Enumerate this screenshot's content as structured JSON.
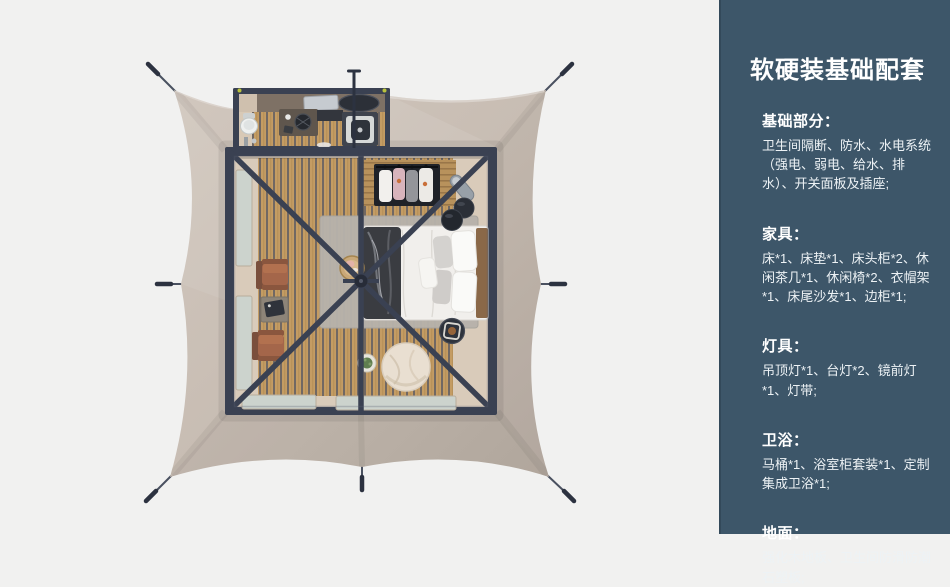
{
  "colors": {
    "bg": "#f1f1f0",
    "canvas-light": "#d1c7be",
    "canvas-mid": "#c7bcb2",
    "canvas-dark": "#b9aea4",
    "frame": "#3a4152",
    "frame-dark": "#2c3240",
    "frame-light": "#59607a",
    "wood": "#c49c63",
    "wood-stripe": "#5d5b63",
    "wood-light": "#b08a52",
    "slat-wood": "#b8925c",
    "slat-stripe": "#8f6c42",
    "beige": "#d9cbba",
    "annex-wall": "#7e7165",
    "window": "#ccd3cd",
    "rug": "#b7b2ab",
    "bed-white": "#f2f0ed",
    "pillow-gray": "#d4d2cf",
    "throw-dark": "#3a3c41",
    "headboard": "#8a6848",
    "chair": "#a4664a",
    "chair-dark": "#7a4f3c",
    "table-gray": "#8d8478",
    "pouf": "#e9dfd1",
    "plant-green": "#5f7d4f",
    "item-dark": "#2b2f37",
    "metal-gray": "#98a0a8",
    "garment-white": "#f2f0ed",
    "garment-pink": "#d8b4bc",
    "garment-gray": "#94959a",
    "accent-orange": "#c9703a",
    "toilet-white": "#eef0ef",
    "yellow-dot": "#b9c23c",
    "sidebar-bg": "#3d5669",
    "sidebar-text": "#f4f7f9"
  },
  "sidebar": {
    "title": "软硬装基础配套",
    "sections": [
      {
        "heading": "基础部分：",
        "body": "卫生间隔断、防水、水电系统（强电、弱电、给水、排水）、开关面板及插座;"
      },
      {
        "heading": "家具：",
        "body": "床*1、床垫*1、床头柜*2、休闲茶几*1、休闲椅*2、衣帽架*1、床尾沙发*1、边柜*1;"
      },
      {
        "heading": "灯具：",
        "body": "吊顶灯*1、台灯*2、镜前灯*1、灯带;"
      },
      {
        "heading": "卫浴：",
        "body": "马桶*1、浴室柜套装*1、定制集成卫浴*1;"
      },
      {
        "heading": "地面：",
        "body": "强化木地板、卫生间防滑防潮石塑板;"
      }
    ]
  }
}
